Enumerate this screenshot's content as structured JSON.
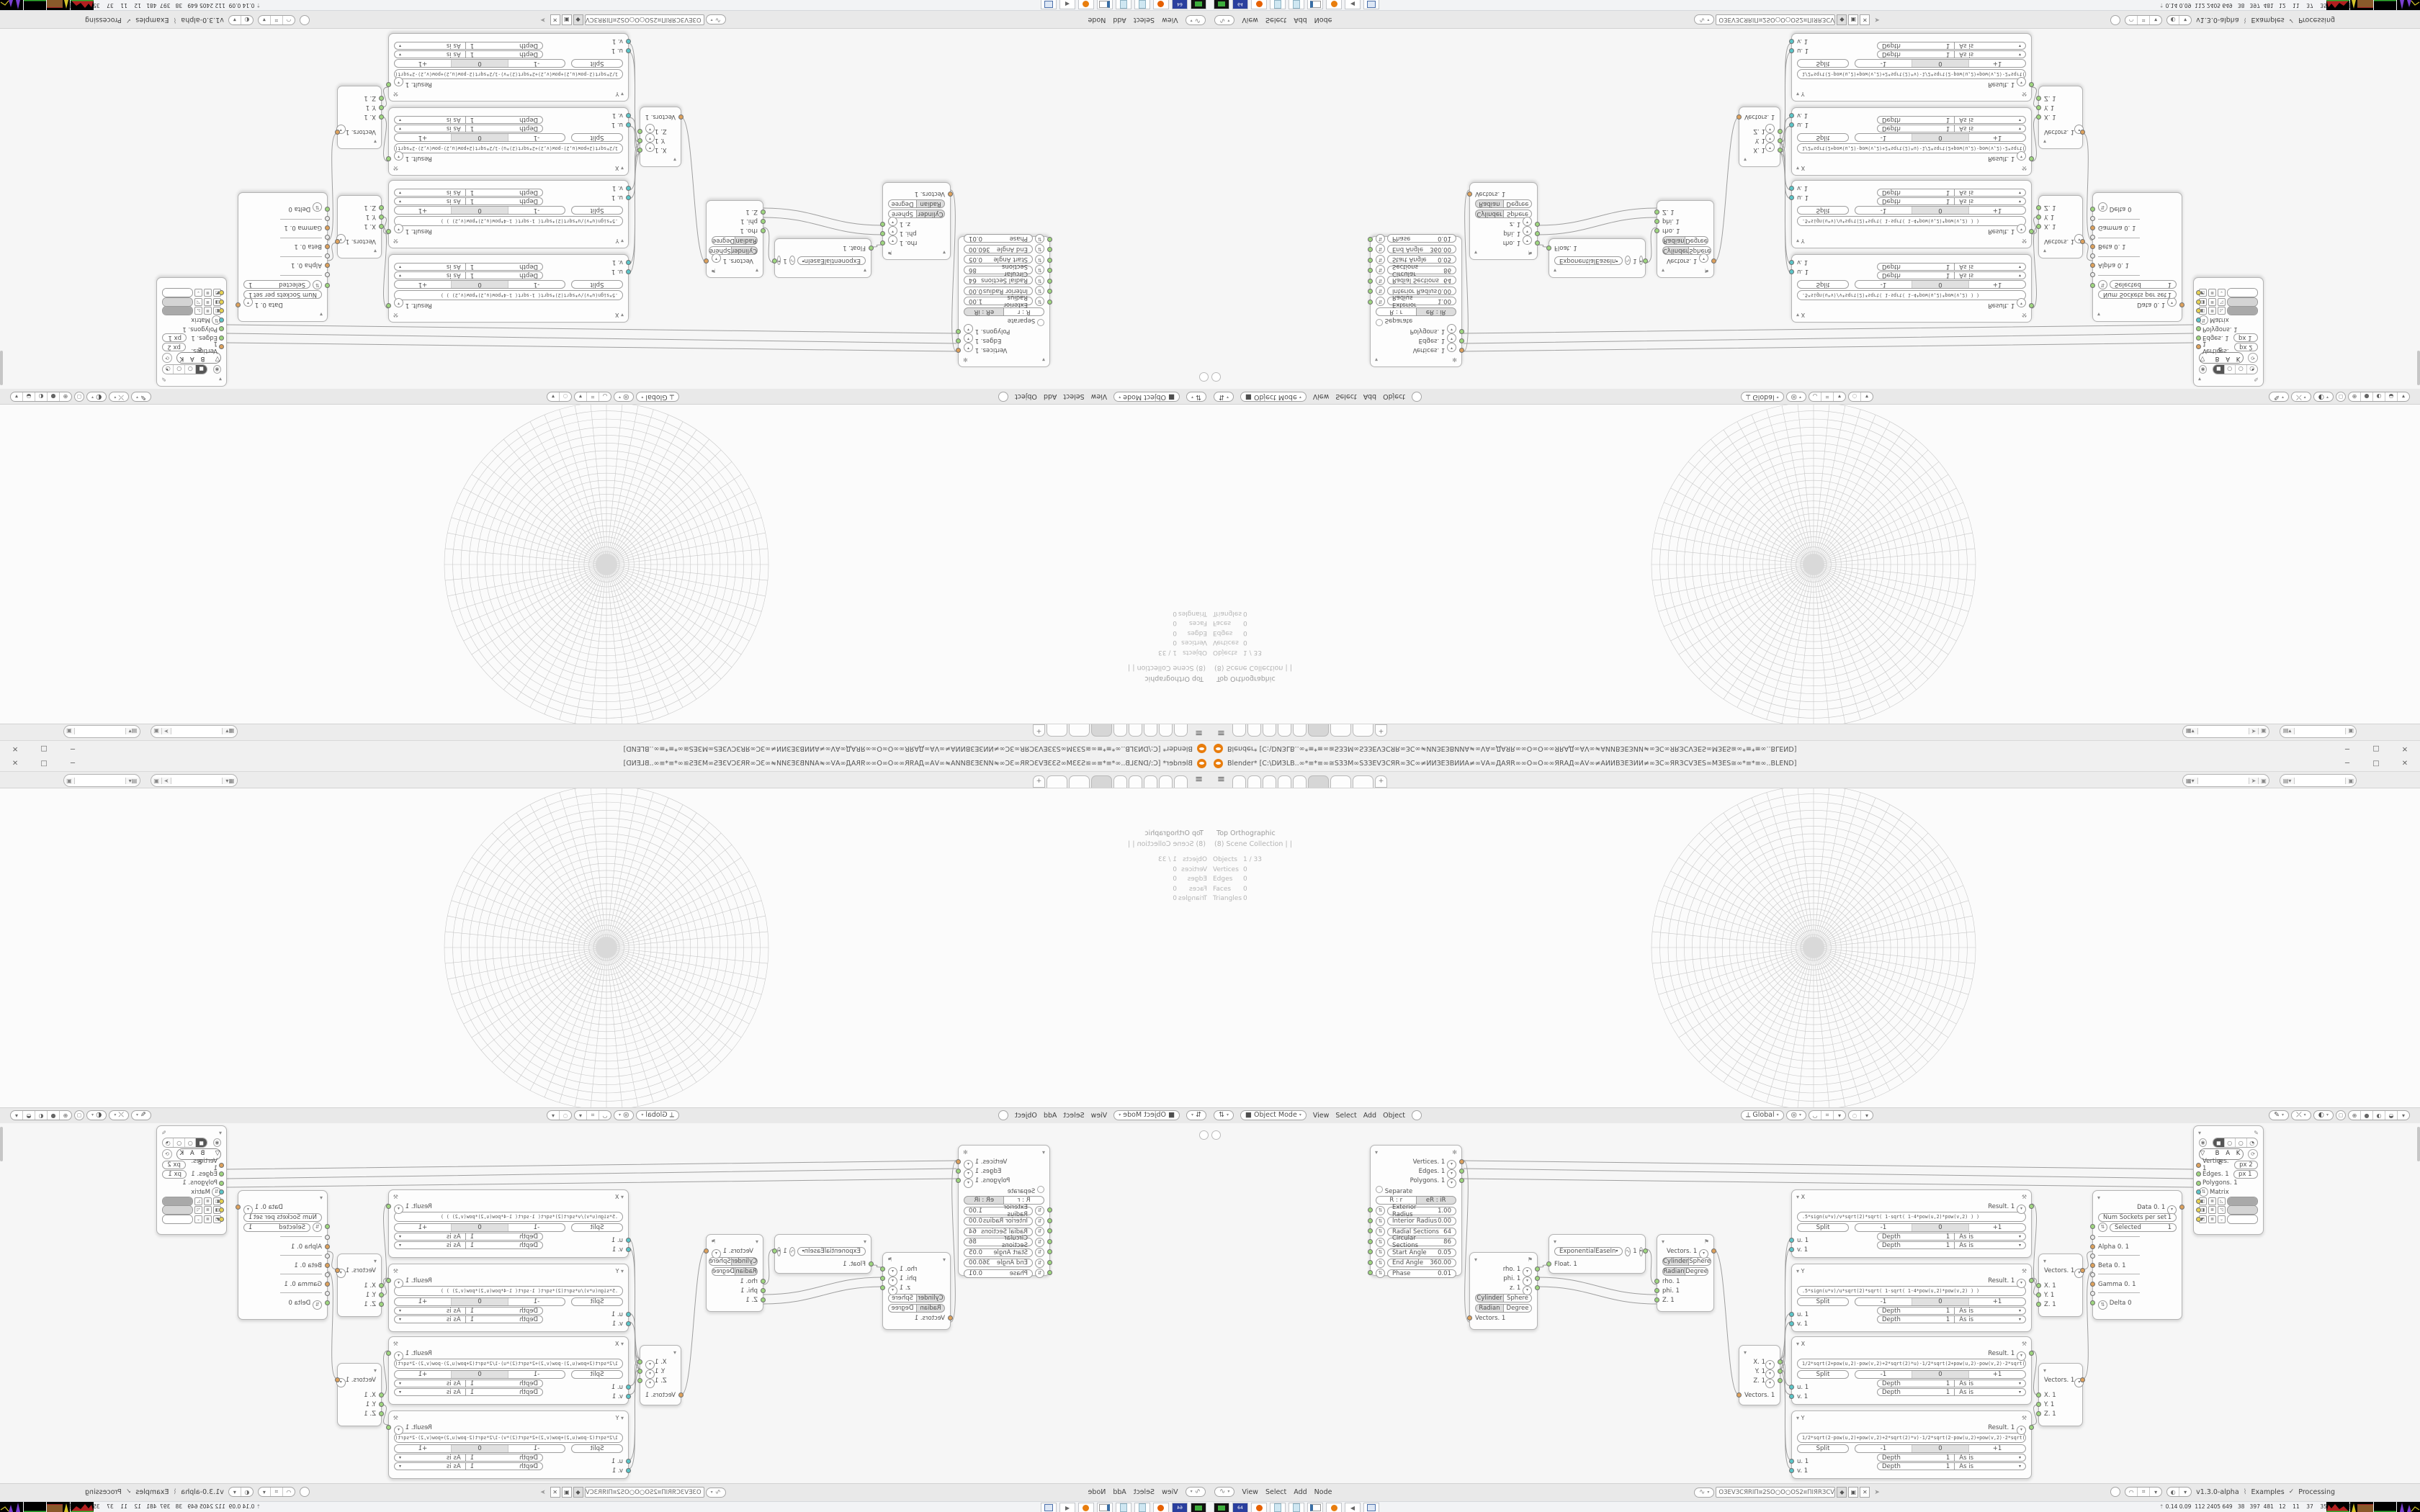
{
  "window": {
    "title": "Blender*  [C:\\DИЗLB..∞*≡*≡∞≅ЅЗЗМ∞ЅЗЗЕVЗСЯR∞ЗС∞≠ИИЗЕЗВИИА≠∞VА∞ДАЯR∞∞О∞О∞∞ЯRАД∞АV∞≠АИИВЗЕЗИИ≠∞ЗС∞ЯRЗСVЗЕЅ∞МЗЕЅ≅∞*≡*≡∞..BLEND]",
    "minimize": "─",
    "maximize": "□",
    "close": "✕"
  },
  "viewport": {
    "view_label": "Top Orthographic",
    "collection_label": "(8) Scene Collection | |",
    "stats": {
      "objects_label": "Objects",
      "objects_value": "1 / 33",
      "vertices_label": "Vertices",
      "vertices_value": "0",
      "edges_label": "Edges",
      "edges_value": "0",
      "faces_label": "Faces",
      "faces_value": "0",
      "triangles_label": "Triangles",
      "triangles_value": "0"
    },
    "header": {
      "mode": "Object Mode",
      "menu_view": "View",
      "menu_select": "Select",
      "menu_add": "Add",
      "menu_object": "Object",
      "orientation": "Global"
    }
  },
  "node_editor": {
    "footer": {
      "menu_view": "View",
      "menu_select": "Select",
      "menu_add": "Add",
      "menu_node": "Node",
      "tree_name": "ОЗЕVЗСЯRІП¤2SО○О○ОS2¤ПІЯRЗСVЗЕО",
      "version": "v1.3.0-alpha",
      "examples": "Examples",
      "check": "✓",
      "processing": "Processing"
    },
    "common": {
      "split": "Split",
      "minus": "-1",
      "zero": "0",
      "plus": "+1",
      "depth": "Depth",
      "depth_val": "1",
      "asis": "As is",
      "cylinder": "Cylinder",
      "sphere": "Sphere",
      "radian": "Radian",
      "degree": "Degree"
    },
    "nodes": {
      "grid": {
        "out_vertices": "Vertices. 1",
        "out_edges": "Edges. 1",
        "out_polygons": "Polygons. 1",
        "separate": "Separate",
        "mode_a": "R : r",
        "mode_b": "eR : iR",
        "p0l": "Exterior Radius",
        "p0v": "1.00",
        "p1l": "Interior Radius",
        "p1v": "0.00",
        "p2l": "Radial Sections",
        "p2v": "64",
        "p3l": "Circular Sections",
        "p3v": "86",
        "p4l": "Start Angle",
        "p4v": "0.05",
        "p5l": "End Angle",
        "p5v": "360.00",
        "p6l": "Phase",
        "p6v": "0.01"
      },
      "split_cyl": {
        "out_rho": "rho. 1",
        "out_phi": "phi. 1",
        "out_z": "z. 1",
        "input": "Vectors. 1"
      },
      "easing": {
        "preset": "ExponentialEaseIn",
        "value": "1",
        "input": "Float. 1"
      },
      "merge_cyl": {
        "output": "Vectors. 1",
        "in_rho": "rho. 1",
        "in_phi": "phi. 1",
        "in_z": "Z. 1"
      },
      "split_xyz": {
        "out_x": "X. 1",
        "out_y": "Y. 1",
        "out_z": "Z. 1",
        "input": "Vectors. 1"
      },
      "expr0": {
        "name": "X",
        "result": "Result. 1",
        "expr": ".5*sign(u*v)/v*sqrt(2)*sqrt(   1-sqrt(   1-4*pow(u,2)*pow(v,2)   )   )",
        "u": "u. 1",
        "v": "v. 1"
      },
      "expr1": {
        "name": "Y",
        "result": "Result. 1",
        "expr": ".5*sign(u*v)/u*sqrt(2)*sqrt(   1-sqrt(   1-4*pow(u,2)*pow(v,2)   )   )",
        "u": "u. 1",
        "v": "v. 1"
      },
      "expr2": {
        "name": "X",
        "result": "Result. 1",
        "expr": "1/2*sqrt(2+pow(u,2)-pow(v,2)+2*sqrt(2)*u)-1/2*sqrt(2+pow(u,2)-pow(v,2)-2*sqrt(2)*u)",
        "u": "u. 1",
        "v": "v. 1"
      },
      "expr3": {
        "name": "Y",
        "result": "Result. 1",
        "expr": "1/2*sqrt(2-pow(u,2)+pow(v,2)+2*sqrt(2)*v)-1/2*sqrt(2-pow(u,2)+pow(v,2)-2*sqrt(2)*v)",
        "u": "u. 1",
        "v": "v. 1"
      },
      "combine0": {
        "output": "Vectors. 1",
        "in_x": "X. 1",
        "in_y": "Y. 1",
        "in_z": "Z. 1"
      },
      "combine1": {
        "output": "Vectors. 1",
        "in_x": "X. 1",
        "in_y": "Y. 1",
        "in_z": "Z. 1"
      },
      "data": {
        "output": "Data 0. 1",
        "field1_label": "Num Sockets per set",
        "field1_value": "1",
        "field2_label": "Selected",
        "field2_value": "1",
        "row_alpha": "Alpha 0. 1",
        "row_beta": "Beta 0. 1",
        "row_gamma": "Gamma 0. 1",
        "row_delta": "Delta 0"
      },
      "bake": {
        "bake_label": "B A K E",
        "in_vertices": "Vertices. 1",
        "px_vertices": "px   2",
        "in_edges": "Edges. 1",
        "px_edges": "px   1",
        "in_polygons": "Polygons. 1",
        "in_matrix": "Matrix"
      }
    }
  },
  "taskbar": {
    "monitor_numbers": "0.14 0.09  112 2405 649   38   397  481   12    11    37    35   6285 8008"
  },
  "colors": {
    "accent_orange": "#e87d0d",
    "socket_green": "#9ed67f",
    "socket_orange": "#dda15c",
    "socket_cyan": "#5ac5c8",
    "socket_yellow": "#e5d152",
    "wire": "#9f9f9f",
    "grid_line": "#c8c8c8"
  }
}
